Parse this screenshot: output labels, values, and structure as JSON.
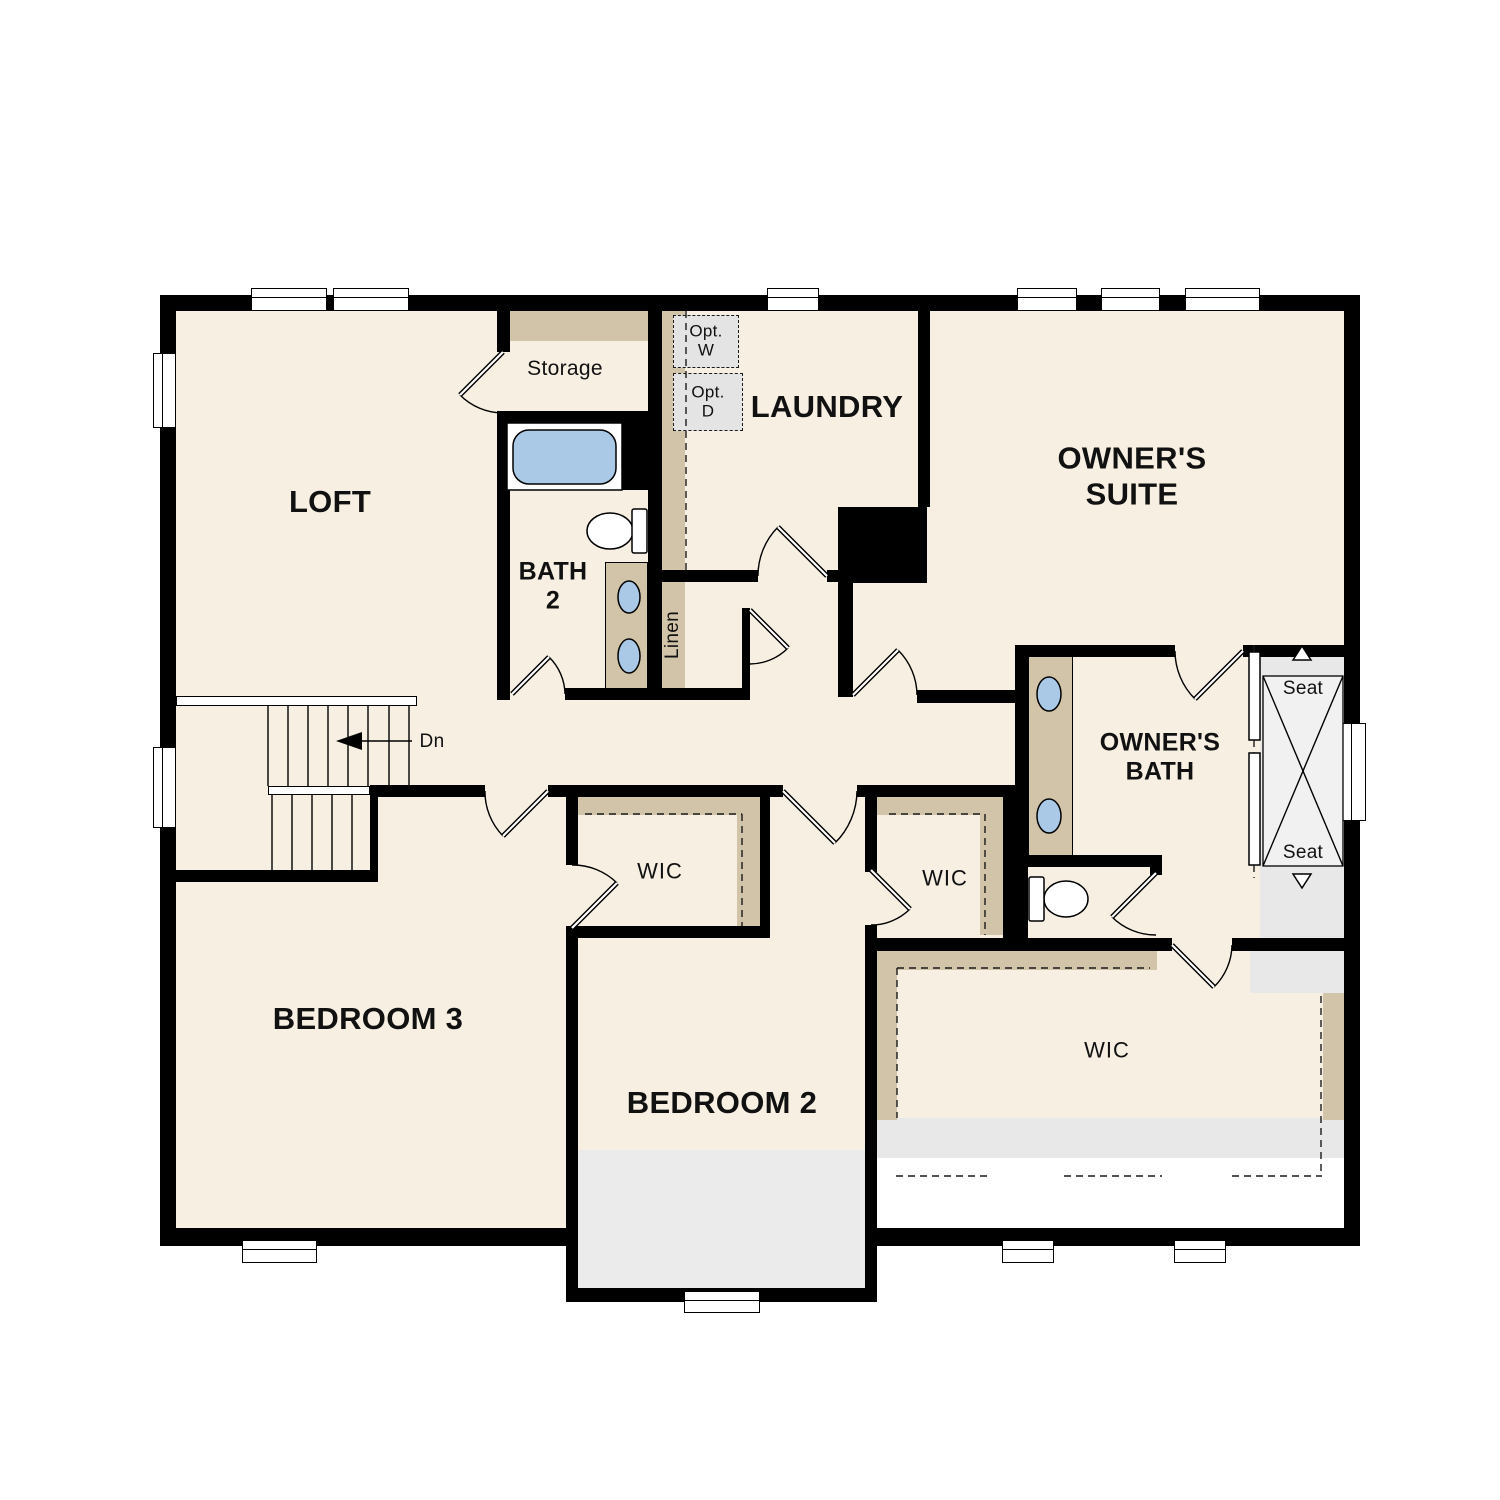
{
  "title": "Second Floor Plan",
  "colors": {
    "background": "#ffffff",
    "wall": "#000000",
    "floor": "#f6efe2",
    "accent_tan": "#d2c4a8",
    "light_gray": "#ebebeb",
    "shower_gray": "#e8e8e8",
    "optional_fill": "#e4e4e4",
    "fixture_blue": "#a9c9e7"
  },
  "rooms": {
    "loft": {
      "label": "LOFT"
    },
    "storage": {
      "label": "Storage"
    },
    "bath2": {
      "label": "BATH\n2"
    },
    "laundry": {
      "label": "LAUNDRY"
    },
    "owners_suite": {
      "label": "OWNER'S\nSUITE"
    },
    "owners_bath": {
      "label": "OWNER'S\nBATH"
    },
    "bedroom3": {
      "label": "BEDROOM 3"
    },
    "bedroom2": {
      "label": "BEDROOM 2"
    },
    "wic_bedroom3": {
      "label": "WIC"
    },
    "wic_bedroom2": {
      "label": "WIC"
    },
    "wic_owners": {
      "label": "WIC"
    },
    "linen": {
      "label": "Linen"
    }
  },
  "annotations": {
    "stairs_down": {
      "label": "Dn"
    },
    "optional_washer": {
      "label": "Opt.\nW"
    },
    "optional_dryer": {
      "label": "Opt.\nD"
    },
    "shower_seat_top": {
      "label": "Seat"
    },
    "shower_seat_bottom": {
      "label": "Seat"
    }
  }
}
